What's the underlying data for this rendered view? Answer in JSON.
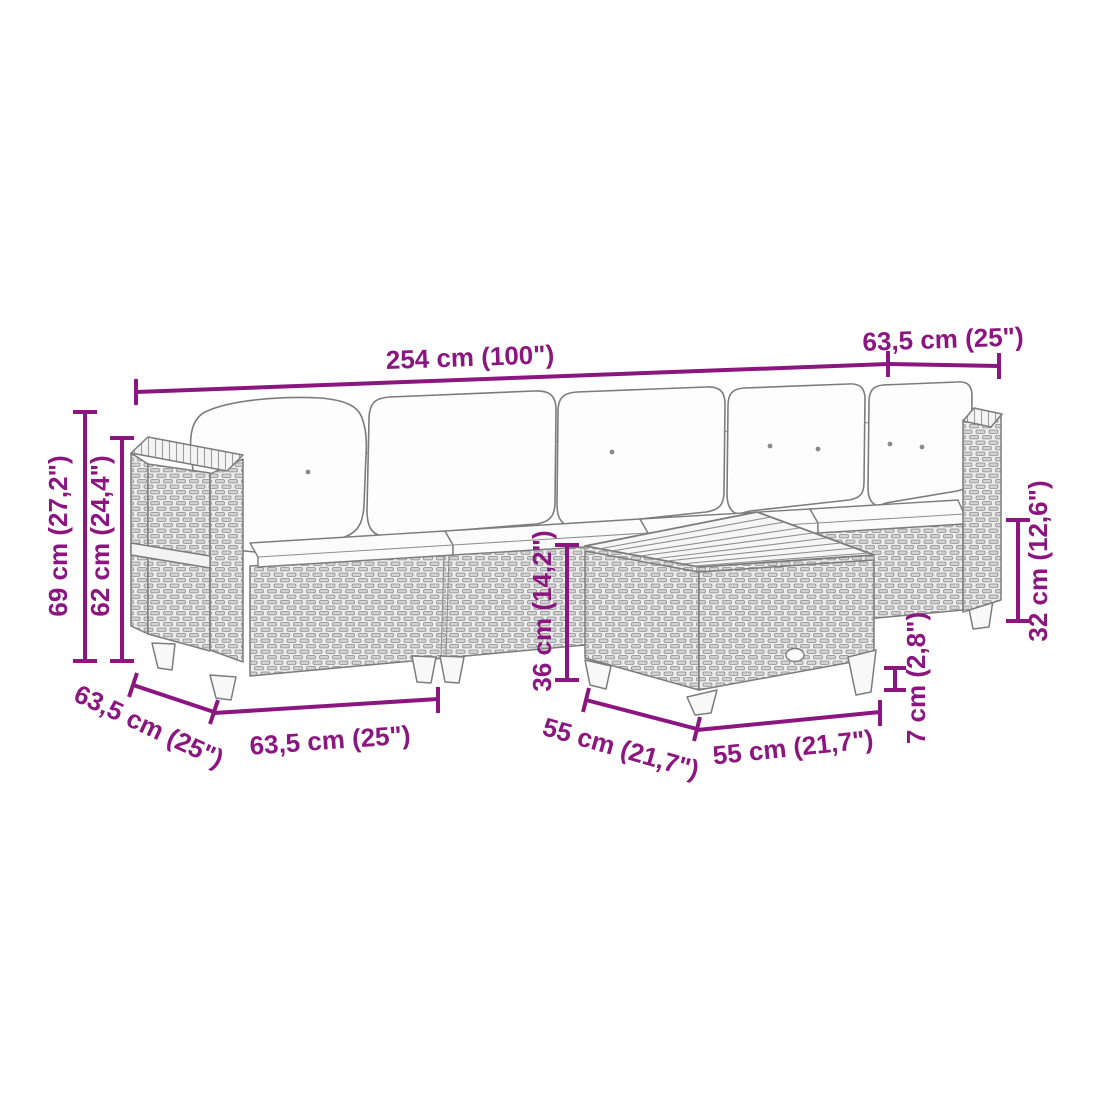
{
  "diagram": {
    "subject": "modular-rattan-lounge-set-with-side-table",
    "accent_color": "#8c1680",
    "line_art_color": "#7c7c7c",
    "background_color": "#ffffff",
    "dimensions": [
      {
        "id": "sofa-total-length",
        "label": "254 cm (100\")"
      },
      {
        "id": "corner-depth-top-right",
        "label": "63,5 cm (25\")"
      },
      {
        "id": "total-height",
        "label": "69 cm (27,2\")"
      },
      {
        "id": "backrest-height",
        "label": "62 cm (24,4\")"
      },
      {
        "id": "corner-depth-bottom-left",
        "label": "63,5 cm (25\")"
      },
      {
        "id": "section-width",
        "label": "63,5 cm (25\")"
      },
      {
        "id": "table-height",
        "label": "36 cm (14,2\")"
      },
      {
        "id": "table-depth",
        "label": "55 cm (21,7\")"
      },
      {
        "id": "table-width",
        "label": "55 cm (21,7\")"
      },
      {
        "id": "table-leg-height",
        "label": "7 cm (2,8\")"
      },
      {
        "id": "rear-section-height",
        "label": "32 cm (12,6\")"
      }
    ]
  }
}
